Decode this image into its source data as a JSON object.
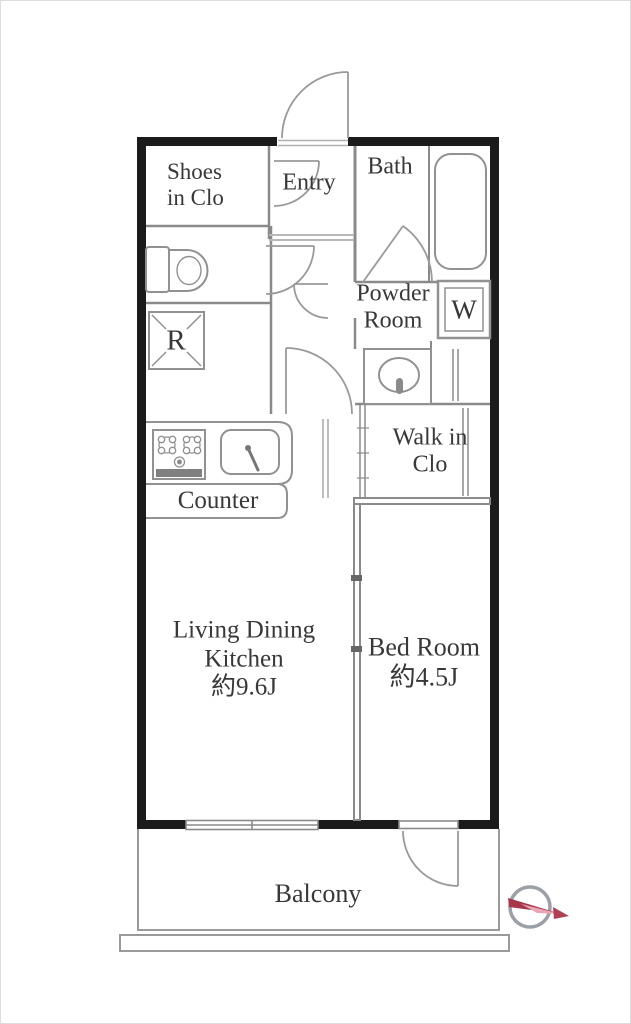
{
  "floorplan": {
    "rooms": {
      "shoes_in_closet": {
        "line1": "Shoes",
        "line2": "in Clo"
      },
      "entry": {
        "label": "Entry"
      },
      "bath": {
        "label": "Bath"
      },
      "powder_room": {
        "line1": "Powder",
        "line2": "Room"
      },
      "washing_machine_space": {
        "label": "W"
      },
      "refrigerator_space": {
        "label": "R"
      },
      "walk_in_closet": {
        "line1": "Walk in",
        "line2": "Clo"
      },
      "kitchen_counter": {
        "label": "Counter"
      },
      "living_dining_kitchen": {
        "line1": "Living Dining",
        "line2": "Kitchen",
        "area": "約9.6J"
      },
      "bed_room": {
        "label": "Bed Room",
        "area": "約4.5J"
      },
      "balcony": {
        "label": "Balcony"
      }
    },
    "fixtures": [
      "bathtub",
      "toilet",
      "washbasin",
      "gas-stove",
      "kitchen-sink",
      "closet-rod",
      "sliding-window",
      "door-swing"
    ],
    "icons": {
      "compass": "compass-icon"
    },
    "colors": {
      "outer_wall": "#1b1b1b",
      "interior_line": "#8a8a8a",
      "fixture_line": "#919191",
      "label_text": "#383838",
      "compass_ring": "#9aa0a6",
      "compass_needle_dark": "#a8374a",
      "compass_needle_light": "#e9a6b4"
    }
  }
}
